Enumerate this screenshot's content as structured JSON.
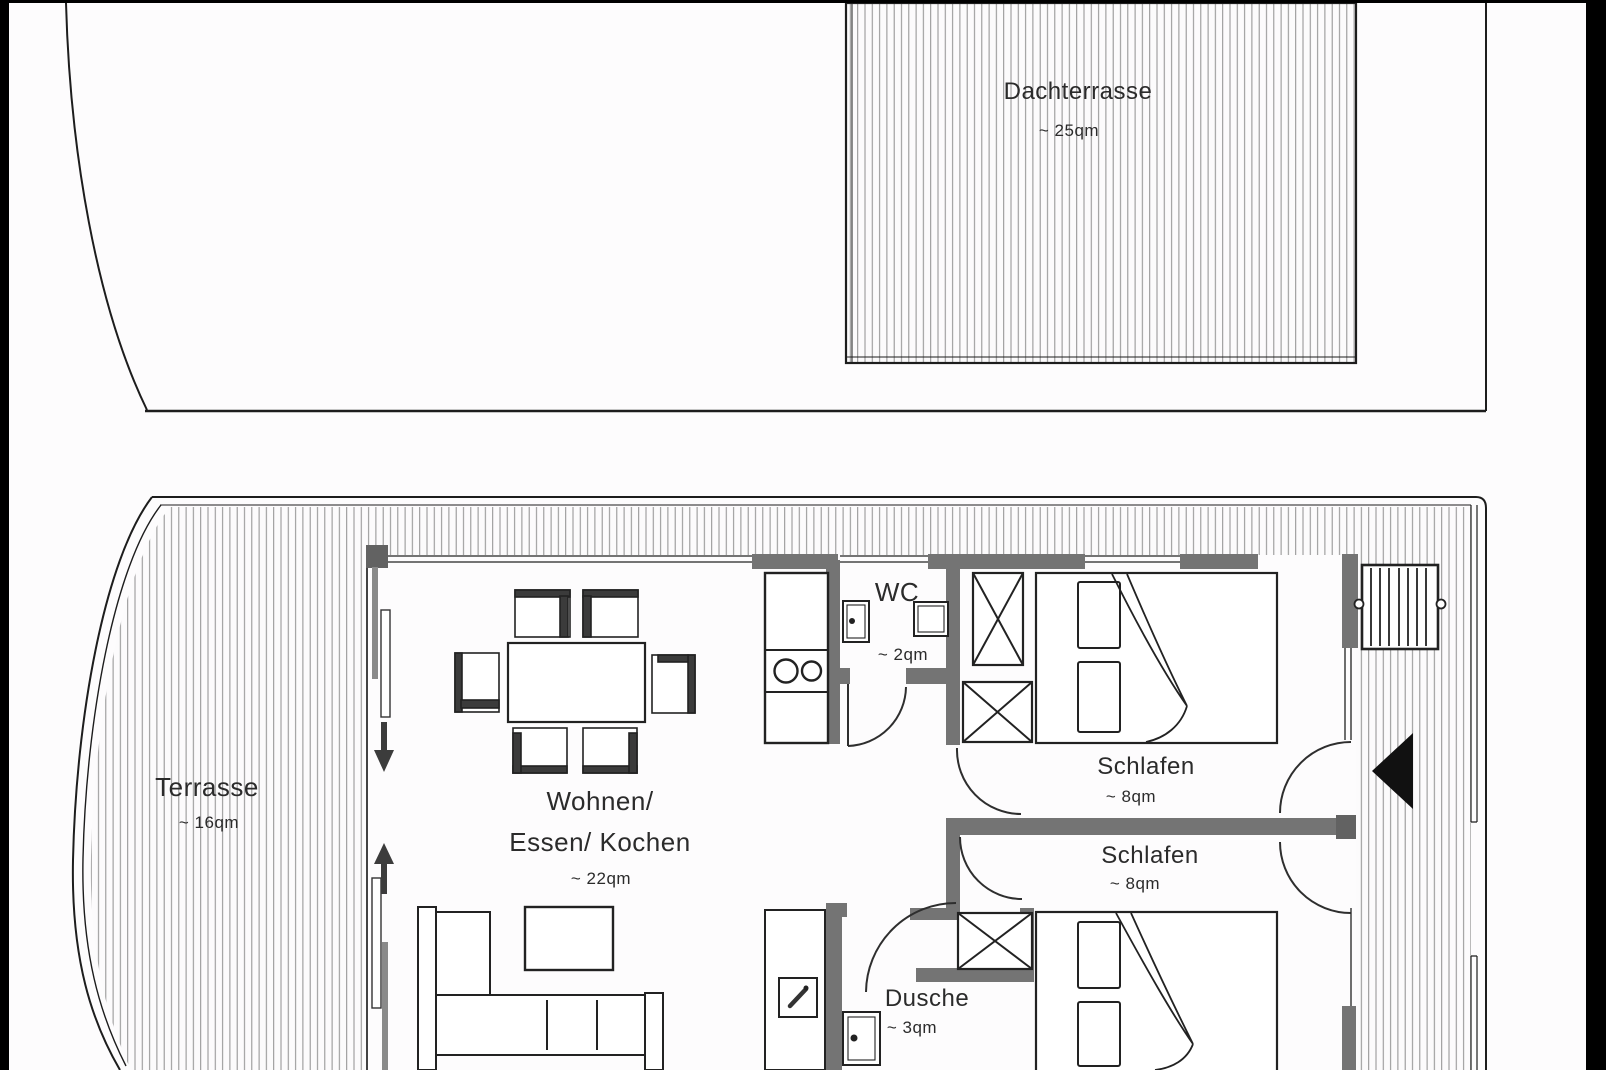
{
  "colors": {
    "background": "#fdfcfd",
    "line": "#1d1d1d",
    "wall_gray": "#747474",
    "hatch": "#8f8f8f",
    "entrance_marker": "#111111"
  },
  "upper_deck": {
    "dachterrasse": {
      "name": "Dachterrasse",
      "area": "~ 25qm"
    }
  },
  "main_deck": {
    "terrasse": {
      "name": "Terrasse",
      "area": "~ 16qm"
    },
    "living": {
      "name_line1": "Wohnen/",
      "name_line2": "Essen/ Kochen",
      "area": "~ 22qm"
    },
    "wc": {
      "name": "WC",
      "area": "~ 2qm"
    },
    "bedroom1": {
      "name": "Schlafen",
      "area": "~ 8qm"
    },
    "bedroom2": {
      "name": "Schlafen",
      "area": "~ 8qm"
    },
    "dusche": {
      "name": "Dusche",
      "area": "~ 3qm"
    }
  }
}
